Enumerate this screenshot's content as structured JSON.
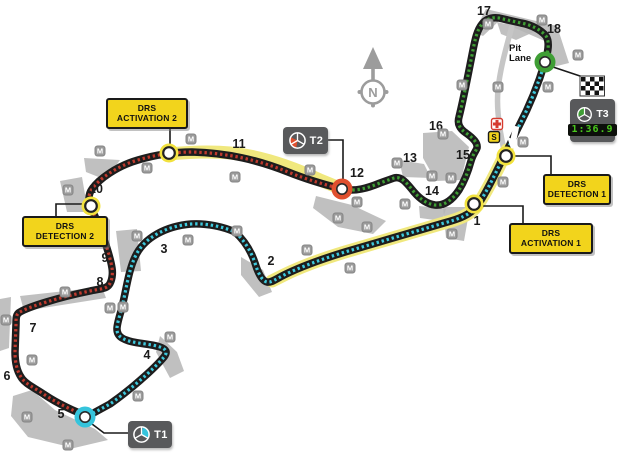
{
  "canvas": {
    "w": 620,
    "h": 464
  },
  "colors": {
    "track_base": "#1d1d1d",
    "sector1": "#3ec9dd",
    "sector2": "#bf3a2e",
    "sector3": "#3f9e35",
    "drs_band": "#f0e87e",
    "drs_halo": "#f2e23e",
    "runoff": "#b5b5b5",
    "pit": "#c6c6c6",
    "connector": "#1a1a1a",
    "compass": "#9c9c9c",
    "medical_red": "#d63b2f",
    "start_yellow": "#f2d41c"
  },
  "track": {
    "sectors": [
      {
        "name": "track-sector-1",
        "color_key": "sector1",
        "path": "M 545 62 C 539 82 529 107 518 128 C 513 138 509 147 504 156 C 497 170 486 194 477 206 C 470 215 459 219 444 223 L 345 252 C 322 259 298 268 284 275 C 276 279 271 283 267 282 C 262 281 258 273 255 263 C 251 251 244 240 235 232 C 224 227 207 223 191 224 C 167 226 144 237 135 257 C 128 272 126 292 121 311 C 117 325 114 333 122 338 C 132 344 148 343 160 347 C 166 349 168 352 164 357 C 154 369 130 390 110 404 L 88 416"
      },
      {
        "name": "track-sector-2",
        "color_key": "sector2",
        "path": "M 88 416 C 75 412 57 403 45 395 C 35 388 25 384 21 377 C 17 371 15 362 15 352 L 16 324 C 16 318 16 314 20 312 C 28 307 60 297 90 291 C 99 289 106 289 109 285 C 112 281 113 274 112 268 C 110 255 101 229 93 212 C 89 203 87 196 92 189 C 99 179 117 166 138 160 C 155 155 172 152 192 152 C 228 153 258 160 288 172 C 308 180 326 185 342 189"
      },
      {
        "name": "track-sector-3",
        "color_key": "sector3",
        "path": "M 342 189 C 355 192 368 188 380 183 L 394 178 C 401 176 406 182 414 192 C 420 199 427 204 435 205 C 445 206 453 199 459 190 C 464 182 468 172 471 161 C 473 154 476 151 477 148 C 478 143 473 138 466 133 C 460 129 457 124 459 117 C 464 97 469 70 473 50 C 475 40 477 30 482 24 C 486 19 492 17 499 18 L 521 23 C 532 25 541 30 546 36 C 550 42 548 52 545 62"
      }
    ]
  },
  "drs_bands": [
    {
      "name": "drs-zone-2-band",
      "path": "M 169 154 C 190 152 210 151 230 153 C 260 156 290 166 320 180 C 330 184 337 187 342 189"
    },
    {
      "name": "drs-zone-1-band",
      "path": "M 507 150 C 500 165 486 193 477 206 C 470 215 459 219 444 223 L 345 252 C 322 259 298 268 284 275 L 272 281"
    }
  ],
  "pit_lane": {
    "path": "M 512 26 C 507 45 500 68 498 90 C 496 110 500 132 504 150"
  },
  "runoffs": [
    "M 474 32 L 486 9 L 557 26 L 569 63 L 553 67 L 547 42 L 499 21 L 483 36 Z",
    "M 423 133 L 452 131 L 469 147 L 461 180 L 436 181 L 423 158 Z",
    "M 399 160 L 424 164 L 431 178 L 403 177 Z",
    "M 316 196 L 352 205 L 386 221 L 373 234 L 338 227 L 313 208 Z",
    "M 241 257 L 263 270 L 272 292 L 259 297 L 241 275 Z",
    "M 160 336 L 177 352 L 184 371 L 170 378 L 156 352 Z",
    "M 13 396 L 32 390 L 55 410 L 95 429 L 108 440 L 74 448 L 28 437 L 11 416 Z",
    "M 0 299 L 11 297 L 9 348 L 0 351 Z",
    "M 20 296 L 102 287 L 106 298 L 24 311 Z",
    "M 60 181 L 82 177 L 88 212 L 67 212 Z",
    "M 84 158 L 120 160 L 106 180 L 86 172 Z",
    "M 116 231 L 137 229 L 141 271 L 121 272 Z",
    "M 419 206 L 446 209 L 442 221 L 420 218 Z",
    "M 443 207 L 470 207 L 464 241 L 446 238 Z",
    "M 497 22 L 536 31 L 516 40 L 501 34 Z"
  ],
  "connectors": [
    {
      "name": "connector-drs-activation-2",
      "path": "M 170 124 L 170 148"
    },
    {
      "name": "connector-drs-detection-2",
      "path": "M 84 204 L 56 204 L 56 216"
    },
    {
      "name": "connector-t2",
      "path": "M 328 140 L 343 140 L 343 182"
    },
    {
      "name": "connector-t1",
      "path": "M 92 424 L 104 433 L 128 433"
    },
    {
      "name": "connector-t3",
      "path": "M 553 67 L 586 78"
    },
    {
      "name": "connector-drs-detection-1",
      "path": "M 512 156 L 551 156 L 551 174"
    },
    {
      "name": "connector-drs-activation-1",
      "path": "M 480 206 L 523 206 L 523 223"
    }
  ],
  "drs_points": [
    {
      "name": "drs-point-activation-2",
      "x": 169,
      "y": 153
    },
    {
      "name": "drs-point-detection-2",
      "x": 91,
      "y": 206
    },
    {
      "name": "drs-point-detection-1",
      "x": 506,
      "y": 156
    },
    {
      "name": "drs-point-activation-1",
      "x": 474,
      "y": 204
    }
  ],
  "sector_points": [
    {
      "name": "sector-point-t3-finish",
      "x": 545,
      "y": 62,
      "color": "#3f9e35"
    },
    {
      "name": "sector-point-t1",
      "x": 85,
      "y": 417,
      "color": "#35c4dc"
    },
    {
      "name": "sector-point-t2",
      "x": 342,
      "y": 189,
      "color": "#e0502f"
    }
  ],
  "turns": [
    {
      "n": "1",
      "x": 477,
      "y": 221
    },
    {
      "n": "2",
      "x": 271,
      "y": 261
    },
    {
      "n": "3",
      "x": 164,
      "y": 249
    },
    {
      "n": "4",
      "x": 147,
      "y": 355
    },
    {
      "n": "5",
      "x": 61,
      "y": 414
    },
    {
      "n": "6",
      "x": 7,
      "y": 376
    },
    {
      "n": "7",
      "x": 33,
      "y": 328
    },
    {
      "n": "8",
      "x": 100,
      "y": 282
    },
    {
      "n": "9",
      "x": 105,
      "y": 258
    },
    {
      "n": "10",
      "x": 96,
      "y": 189
    },
    {
      "n": "11",
      "x": 239,
      "y": 144
    },
    {
      "n": "12",
      "x": 357,
      "y": 173
    },
    {
      "n": "13",
      "x": 410,
      "y": 158
    },
    {
      "n": "14",
      "x": 432,
      "y": 191
    },
    {
      "n": "15",
      "x": 463,
      "y": 155
    },
    {
      "n": "16",
      "x": 436,
      "y": 126
    },
    {
      "n": "17",
      "x": 484,
      "y": 11
    },
    {
      "n": "18",
      "x": 554,
      "y": 29
    }
  ],
  "marshal": {
    "label": "M"
  },
  "marshals": [
    [
      488,
      24
    ],
    [
      542,
      20
    ],
    [
      578,
      55
    ],
    [
      462,
      85
    ],
    [
      498,
      87
    ],
    [
      548,
      87
    ],
    [
      523,
      142
    ],
    [
      503,
      182
    ],
    [
      443,
      134
    ],
    [
      432,
      176
    ],
    [
      451,
      178
    ],
    [
      397,
      163
    ],
    [
      405,
      204
    ],
    [
      452,
      234
    ],
    [
      357,
      202
    ],
    [
      338,
      218
    ],
    [
      367,
      227
    ],
    [
      310,
      170
    ],
    [
      191,
      139
    ],
    [
      235,
      177
    ],
    [
      147,
      168
    ],
    [
      100,
      151
    ],
    [
      68,
      190
    ],
    [
      137,
      236
    ],
    [
      188,
      240
    ],
    [
      237,
      231
    ],
    [
      307,
      250
    ],
    [
      350,
      268
    ],
    [
      65,
      292
    ],
    [
      110,
      308
    ],
    [
      123,
      307
    ],
    [
      6,
      320
    ],
    [
      32,
      360
    ],
    [
      27,
      417
    ],
    [
      68,
      445
    ],
    [
      170,
      337
    ],
    [
      138,
      396
    ]
  ],
  "drs_boxes": [
    {
      "id": "drs-activation-2",
      "line1": "DRS",
      "line2": "ACTIVATION 2",
      "x": 106,
      "y": 98,
      "w": 78,
      "h": 27
    },
    {
      "id": "drs-detection-2",
      "line1": "DRS",
      "line2": "DETECTION 2",
      "x": 22,
      "y": 216,
      "w": 82,
      "h": 27
    },
    {
      "id": "drs-detection-1",
      "line1": "DRS",
      "line2": "DETECTION 1",
      "x": 543,
      "y": 174,
      "w": 64,
      "h": 27
    },
    {
      "id": "drs-activation-1",
      "line1": "DRS",
      "line2": "ACTIVATION 1",
      "x": 509,
      "y": 223,
      "w": 80,
      "h": 27
    }
  ],
  "sector_boxes": [
    {
      "id": "t1",
      "label": "T1",
      "x": 128,
      "y": 421,
      "w": 44,
      "h": 27,
      "color": "#35c4dc",
      "wedge": [
        -80,
        25
      ]
    },
    {
      "id": "t2",
      "label": "T2",
      "x": 283,
      "y": 127,
      "w": 45,
      "h": 27,
      "color": "#e0502f",
      "wedge": [
        100,
        205
      ]
    }
  ],
  "t3_box": {
    "id": "t3",
    "label": "T3",
    "time": "1:36.9",
    "x": 570,
    "y": 99,
    "w": 45,
    "h": 39,
    "color": "#3f9e35",
    "wedge": [
      165,
      268
    ]
  },
  "pit_label": {
    "line1": "Pit",
    "line2": "Lane",
    "x": 509,
    "y": 44
  },
  "compass": {
    "letter": "N",
    "cx": 373,
    "cy": 92
  },
  "flag": {
    "x": 581,
    "y": 77,
    "rows": 4,
    "cols": 5,
    "cell": 4.5
  },
  "start_marker": {
    "label": "S",
    "x": 494,
    "y": 137
  },
  "medical": {
    "x": 497,
    "y": 124
  },
  "direction_arrow": {
    "x": 514,
    "y": 137,
    "angle": 12
  }
}
